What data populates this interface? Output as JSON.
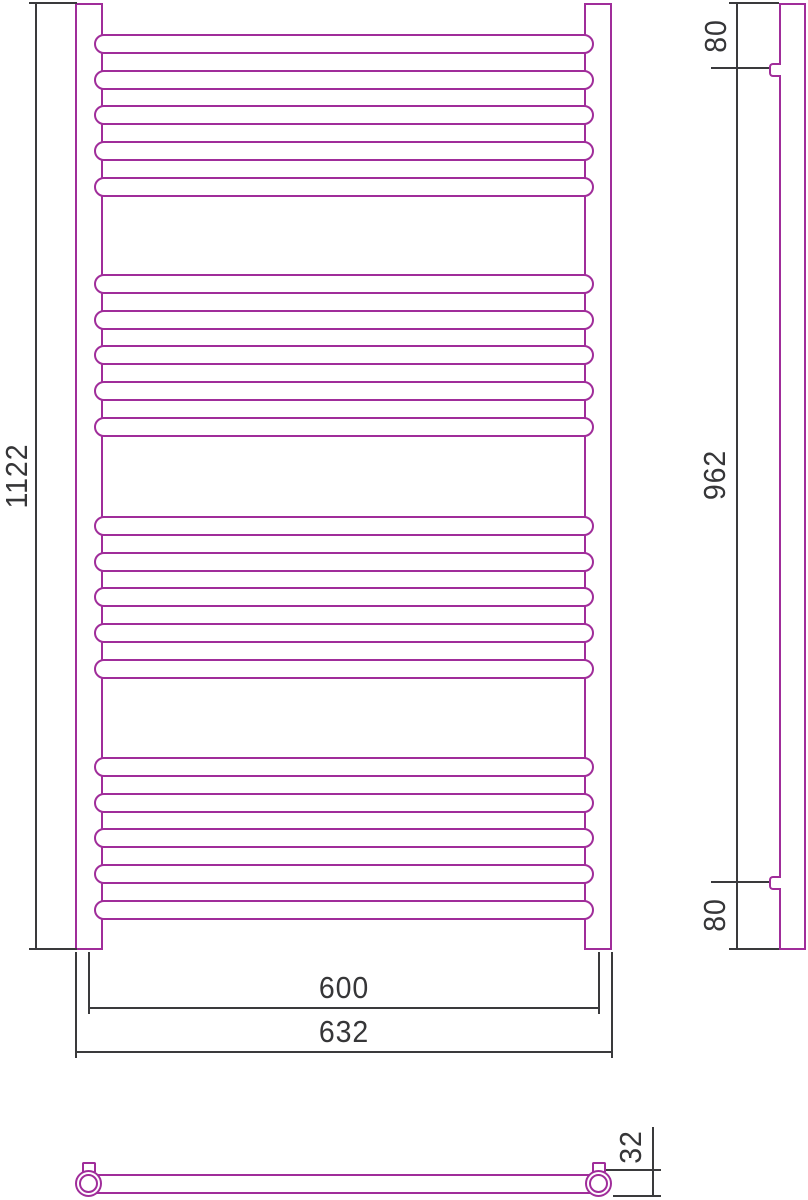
{
  "colors": {
    "drawing_line": "#a02d9a",
    "dimension_line": "#3a3a3c",
    "background": "#ffffff"
  },
  "dimensions": {
    "overall_height": "1122",
    "rail_center_spacing": "600",
    "overall_width": "632",
    "bracket_top_offset": "80",
    "bracket_spacing": "962",
    "bracket_bottom_offset": "80",
    "tube_diameter": "32"
  },
  "front_view": {
    "rung_count": 20,
    "rung_groups": 4,
    "rungs_per_group": 5,
    "rung_centers_y": [
      44,
      80,
      115,
      151,
      187,
      284,
      320,
      355,
      391,
      427,
      526,
      562,
      597,
      633,
      669,
      767,
      803,
      838,
      874,
      910
    ]
  }
}
